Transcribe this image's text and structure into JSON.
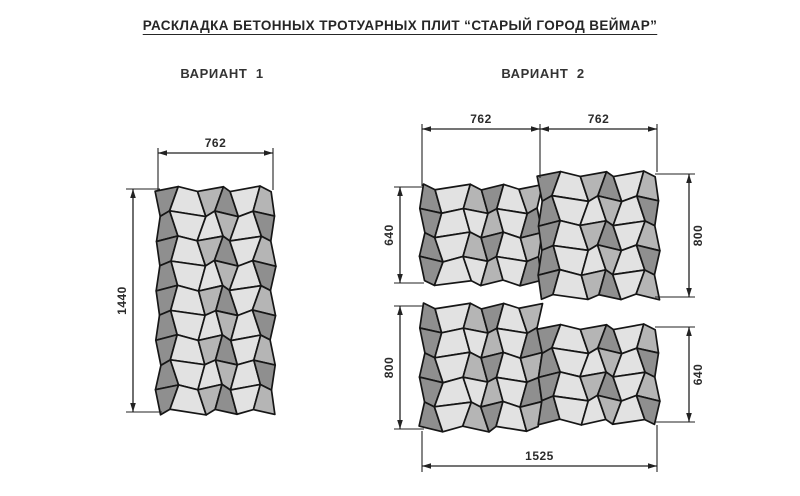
{
  "title": "РАСКЛАДКА БЕТОННЫХ ТРОТУАРНЫХ ПЛИТ “СТАРЫЙ ГОРОД ВЕЙМАР”",
  "variant_1": {
    "label": "ВАРИАНТ  1"
  },
  "variant_2": {
    "label": "ВАРИАНТ  2"
  },
  "palette": {
    "tile_dark": "#8f8f8f",
    "tile_medium": "#b5b5b5",
    "tile_light": "#e2e2e2",
    "outline": "#161616",
    "dimension": "#222222"
  },
  "dimensions": {
    "v1_width": "762",
    "v1_height": "1440",
    "v2_top_left_width": "762",
    "v2_top_right_width": "762",
    "v2_top_left_height": "640",
    "v2_top_right_height": "800",
    "v2_bottom_left_height": "800",
    "v2_bottom_right_height": "640",
    "v2_total_width": "1525"
  },
  "blocks": [
    {
      "id": "variant1",
      "rows": 9,
      "tiles_per_row": 6,
      "width_mm": 762,
      "height_mm": 1440
    },
    {
      "id": "variant2-top-left",
      "rows": 4,
      "tiles_per_row": 6,
      "width_mm": 762,
      "height_mm": 640
    },
    {
      "id": "variant2-top-right",
      "rows": 5,
      "tiles_per_row": 6,
      "width_mm": 762,
      "height_mm": 800
    },
    {
      "id": "variant2-bottom-left",
      "rows": 5,
      "tiles_per_row": 6,
      "width_mm": 762,
      "height_mm": 800
    },
    {
      "id": "variant2-bottom-right",
      "rows": 4,
      "tiles_per_row": 6,
      "width_mm": 762,
      "height_mm": 640
    }
  ]
}
